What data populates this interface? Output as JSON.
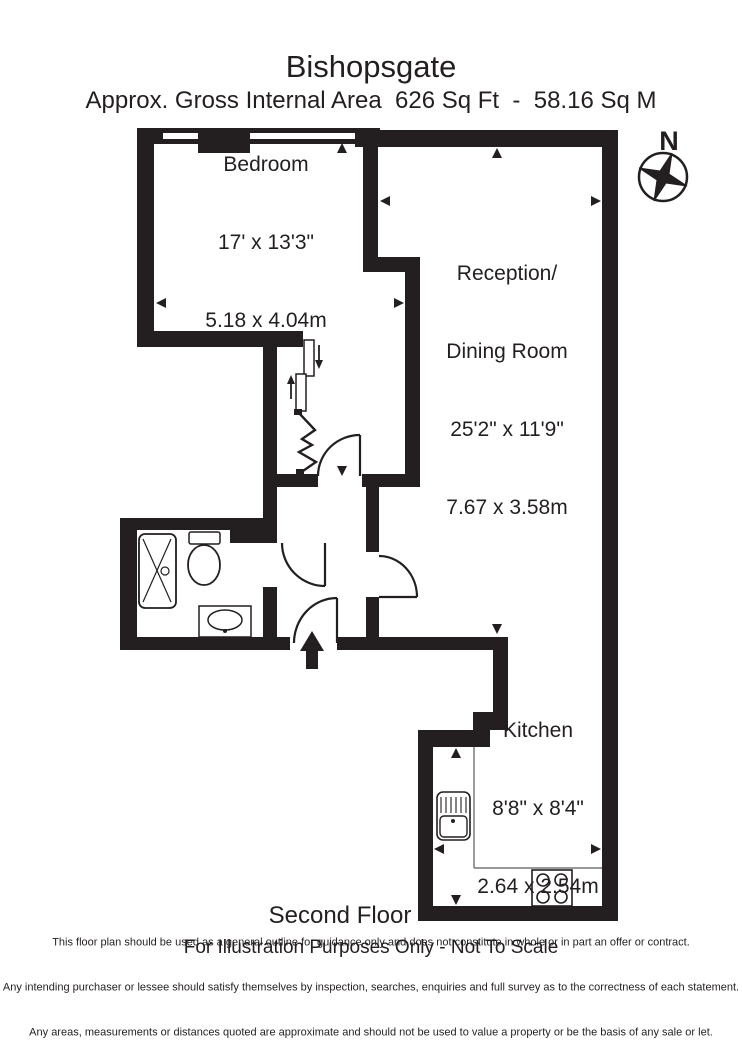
{
  "title": "Bishopsgate",
  "subtitle": "Approx. Gross Internal Area  626 Sq Ft  -  58.16 Sq M",
  "compass": {
    "label": "N"
  },
  "rooms": {
    "bedroom": {
      "name": "Bedroom",
      "dimensions_imperial": "17' x 13'3\"",
      "dimensions_metric": "5.18 x 4.04m"
    },
    "reception": {
      "name_line1": "Reception/",
      "name_line2": "Dining Room",
      "dimensions_imperial": "25'2\" x 11'9\"",
      "dimensions_metric": "7.67 x 3.58m"
    },
    "kitchen": {
      "name": "Kitchen",
      "dimensions_imperial": "8'8\" x 8'4\"",
      "dimensions_metric": "2.64 x 2.54m"
    }
  },
  "floor_label": "Second Floor",
  "scale_note": "For Illustration Purposes Only - Not To Scale",
  "disclaimer": [
    "This floor plan should be used as a general outline for guidance only and does not constitute in whole or in part an offer or contract.",
    "Any intending purchaser or lessee should satisfy themselves by inspection, searches, enquiries and full survey as to the correctness of each statement.",
    "Any areas, measurements or distances quoted are approximate and should not be used to value a property or be the basis of any sale or let."
  ],
  "colors": {
    "wall": "#231f20",
    "background": "#ffffff"
  }
}
